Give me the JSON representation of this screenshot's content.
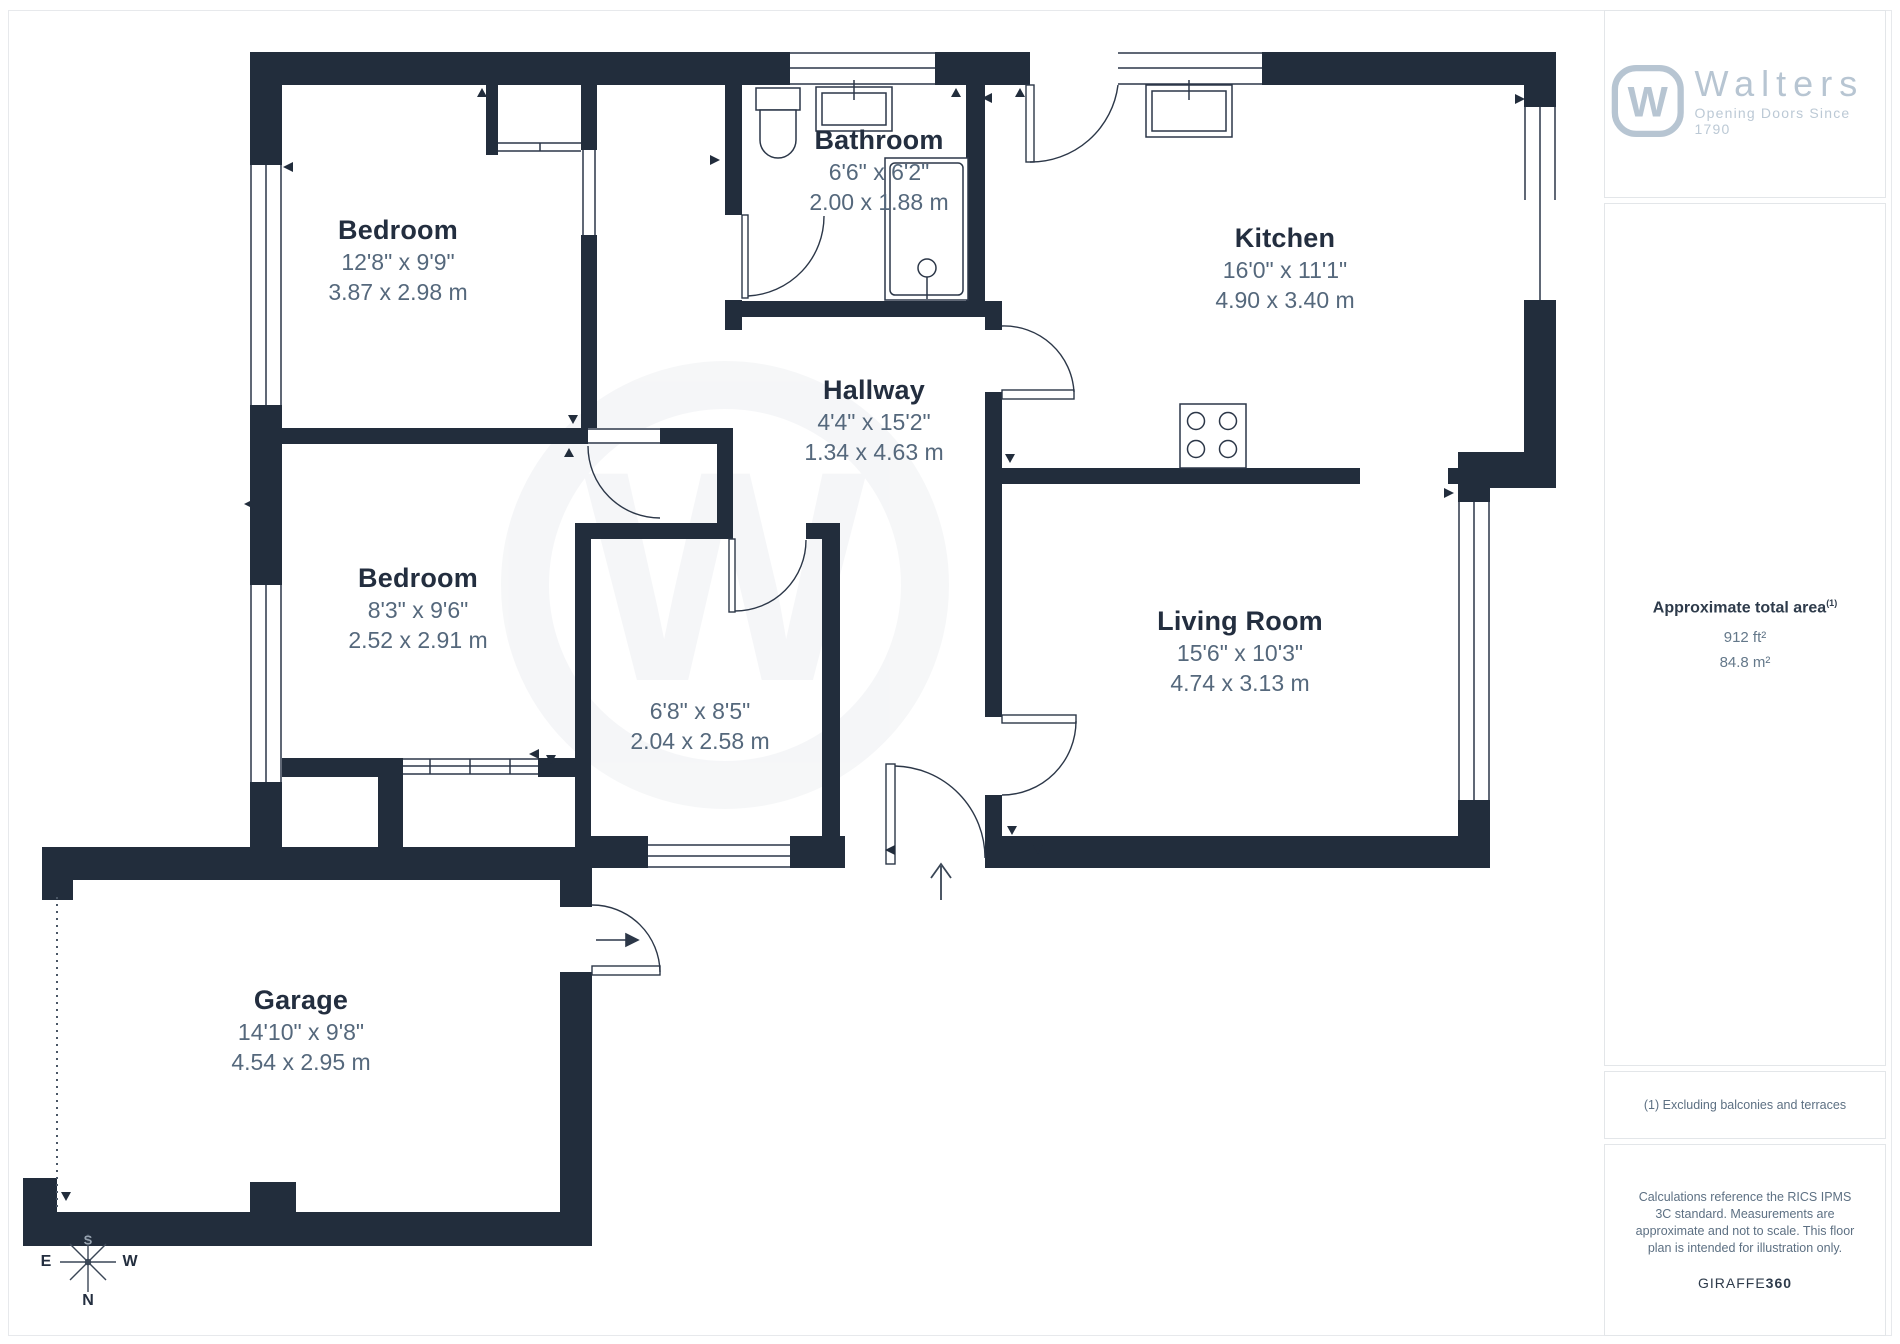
{
  "branding": {
    "name": "Walters",
    "tagline": "Opening Doors Since 1790",
    "logo_letter": "W",
    "watermark_letter": "W",
    "accent_color": "#b7c5d2",
    "wall_color": "#222d3c"
  },
  "rooms": [
    {
      "name": "Bedroom",
      "imperial": "12'8\" x 9'9\"",
      "metric": "3.87 x 2.98 m"
    },
    {
      "name": "Bathroom",
      "imperial": "6'6\" x 6'2\"",
      "metric": "2.00 x 1.88 m"
    },
    {
      "name": "Kitchen",
      "imperial": "16'0\" x 11'1\"",
      "metric": "4.90 x 3.40 m"
    },
    {
      "name": "Hallway",
      "imperial": "4'4\" x 15'2\"",
      "metric": "1.34 x 4.63 m"
    },
    {
      "name": "Bedroom",
      "imperial": "8'3\" x 9'6\"",
      "metric": "2.52 x 2.91 m"
    },
    {
      "name": "",
      "imperial": "6'8\" x 8'5\"",
      "metric": "2.04 x 2.58 m"
    },
    {
      "name": "Living Room",
      "imperial": "15'6\" x 10'3\"",
      "metric": "4.74 x 3.13 m"
    },
    {
      "name": "Garage",
      "imperial": "14'10\" x 9'8\"",
      "metric": "4.54 x 2.95 m"
    }
  ],
  "compass": {
    "n": "N",
    "e": "E",
    "w": "W",
    "s": "S"
  },
  "sidebar": {
    "area_title": "Approximate total area",
    "area_title_sup": "(1)",
    "area_imperial": "912 ft²",
    "area_metric": "84.8 m²",
    "footnote": "(1) Excluding balconies and terraces",
    "disclaimer": "Calculations reference the RICS IPMS 3C standard. Measurements are approximate and not to scale. This floor plan is intended for illustration only.",
    "brand_credit_regular": "GIRAFFE",
    "brand_credit_bold": "360"
  }
}
